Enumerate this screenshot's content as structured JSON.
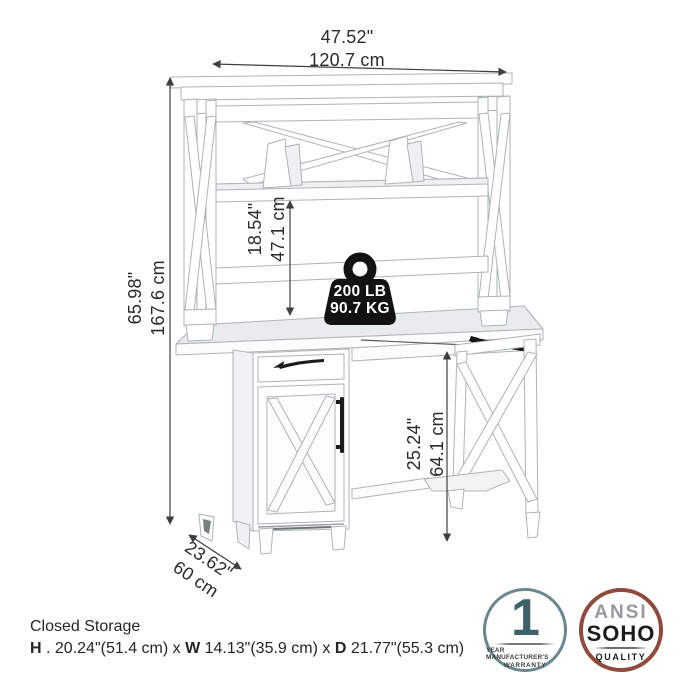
{
  "annotations": {
    "overall_width": {
      "inches": "47.52\"",
      "cm": "120.7 cm"
    },
    "overall_height": {
      "inches": "65.98\"",
      "cm": "167.6 cm"
    },
    "hutch_opening_height": {
      "inches": "18.54\"",
      "cm": "47.1 cm"
    },
    "knee_space_height": {
      "inches": "25.24\"",
      "cm": "64.1 cm"
    },
    "depth": {
      "inches": "23.62\"",
      "cm": "60 cm"
    },
    "weight_capacity": {
      "line1": "200 LB",
      "line2": "90.7 KG"
    }
  },
  "closed_storage": {
    "title": "Closed Storage",
    "h_label": "H",
    "h_text": " . 20.24\"(51.4 cm) x ",
    "w_label": "W",
    "w_text": " 14.13\"(35.9 cm) x ",
    "d_label": "D",
    "d_text": " 21.77\"(55.3 cm)"
  },
  "badges": {
    "warranty": {
      "number": "1",
      "line1": "YEAR MANUFACTURER'S",
      "line2": "WARRANTY"
    },
    "quality": {
      "line1": "ANSI",
      "line2": "SOHO",
      "line3": "QUALITY"
    }
  },
  "colors": {
    "ink": "#2b2b2b",
    "furniture_outline": "#aeb3b6",
    "weight_badge": "#121212",
    "warranty_border": "#6b868c",
    "warranty_number": "#3d6069",
    "quality_border": "#8e4a3c",
    "quality_ansi": "#97999c"
  }
}
